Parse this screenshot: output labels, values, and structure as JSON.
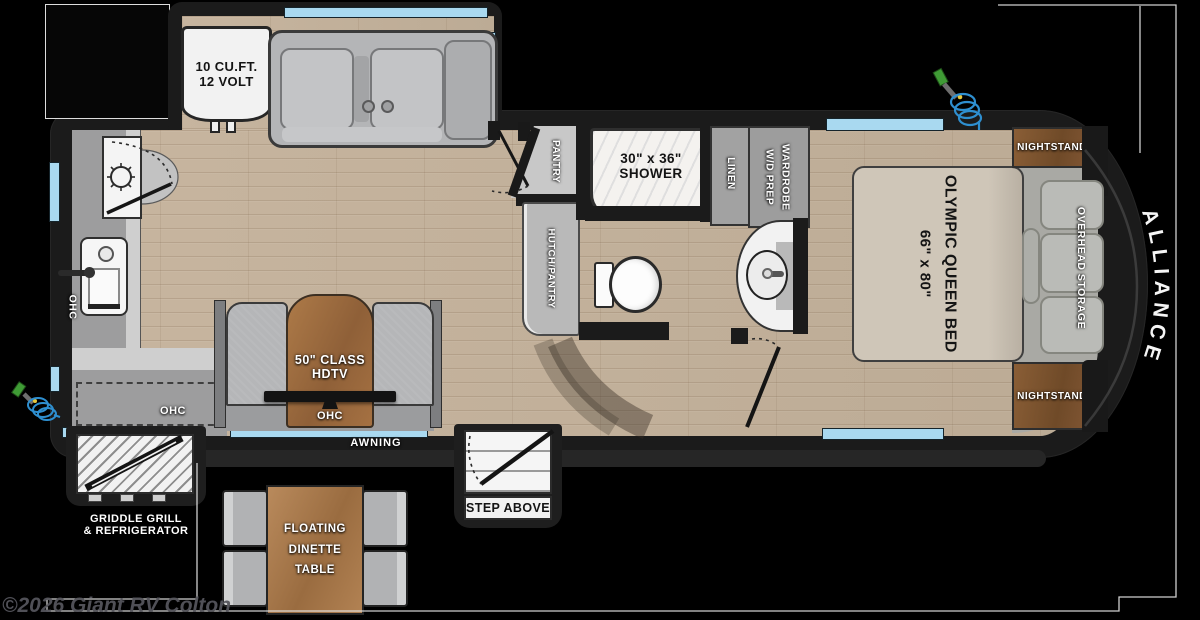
{
  "floorplan": {
    "brand": "ALLIANCE",
    "watermark": "©2026 Giant RV Colton",
    "labels": {
      "fridge_line1": "10 CU.FT.",
      "fridge_line2": "12 VOLT",
      "pantry": "PANTRY",
      "hutch_pantry": "HUTCH/PANTRY",
      "shower_line1": "30\" x 36\"",
      "shower_line2": "SHOWER",
      "linen": "LINEN",
      "wardrobe_line1": "WARDROBE",
      "wardrobe_line2": "W/D PREP",
      "bed_line1": "OLYMPIC QUEEN BED",
      "bed_line2": "66\" x 80\"",
      "nightstand": "NIGHTSTAND",
      "overhead_storage": "OVERHEAD STORAGE",
      "ohc": "OHC",
      "tv_line1": "50\" CLASS",
      "tv_line2": "HDTV",
      "awning": "AWNING",
      "step": "STEP ABOVE",
      "dinette_line1": "FLOATING",
      "dinette_line2": "DINETTE",
      "dinette_line3": "TABLE",
      "griddle_line1": "GRIDDLE GRILL",
      "griddle_line2": "& REFRIGERATOR"
    },
    "colors": {
      "body": "#1b1b1b",
      "window": "#a9d9f0",
      "floor_wood": "#c3b19c",
      "nightstand_wood": "#7d5431",
      "tv_wood": "#a06f42",
      "table_wood": "#ad7d52",
      "hose_blue": "#2e8fd0",
      "nozzle_green": "#3f9b35",
      "outline_white": "#e8e8e8"
    }
  }
}
